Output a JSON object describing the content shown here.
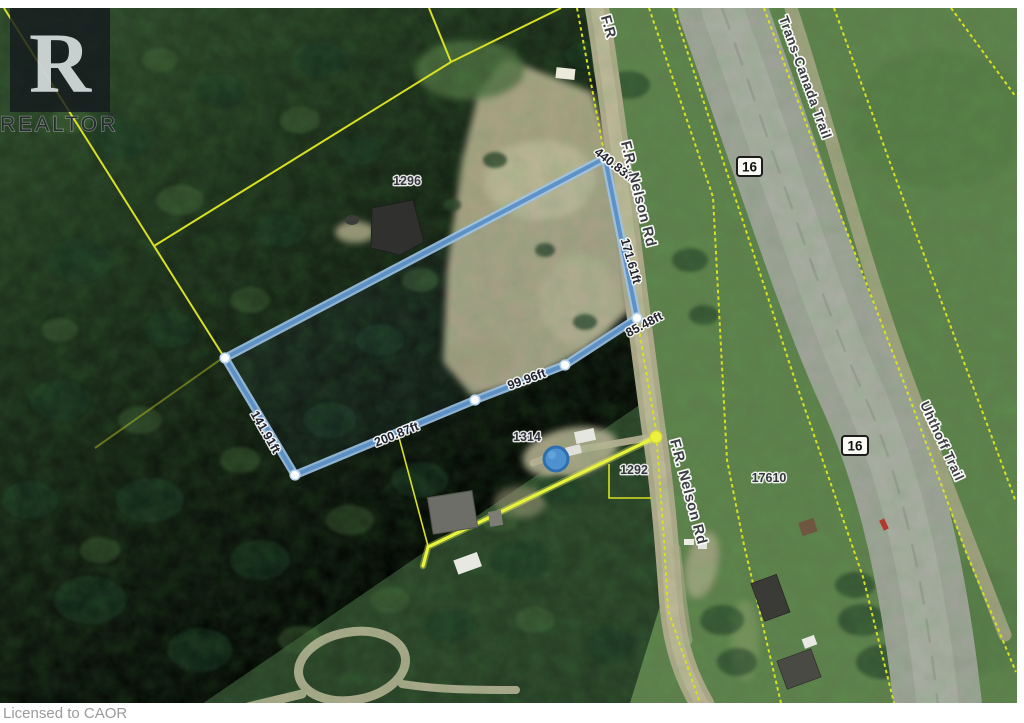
{
  "branding": {
    "logo_letter": "R",
    "logo_text": "REALTOR",
    "registered_mark": "®",
    "license_text": "Licensed to CAOR"
  },
  "map": {
    "highway_shield": "16",
    "roads": {
      "nelson_partial_top": "F.R",
      "nelson_upper": "F.R. Nelson Rd",
      "nelson_lower": "F.R. Nelson Rd",
      "trans_canada_trail": "Trans-Canada Trail",
      "uhthoff_trail": "Uhthoff Trail"
    },
    "parcel_numbers": {
      "p1296": "1296",
      "p1314": "1314",
      "p1292": "1292",
      "p17610": "17610"
    },
    "boundary_measurements": {
      "north_edge": "440.83ft",
      "road_edge": "171.61ft",
      "east_upper_edge": "85.48ft",
      "east_lower_edge": "99.96ft",
      "south_edge": "200.87ft",
      "west_edge": "141.91ft"
    },
    "colors": {
      "subject_boundary_blue": "#76a9d8",
      "parcel_line_yellow": "#d8e021",
      "highlight_line_yellow": "#e8f43c"
    }
  }
}
